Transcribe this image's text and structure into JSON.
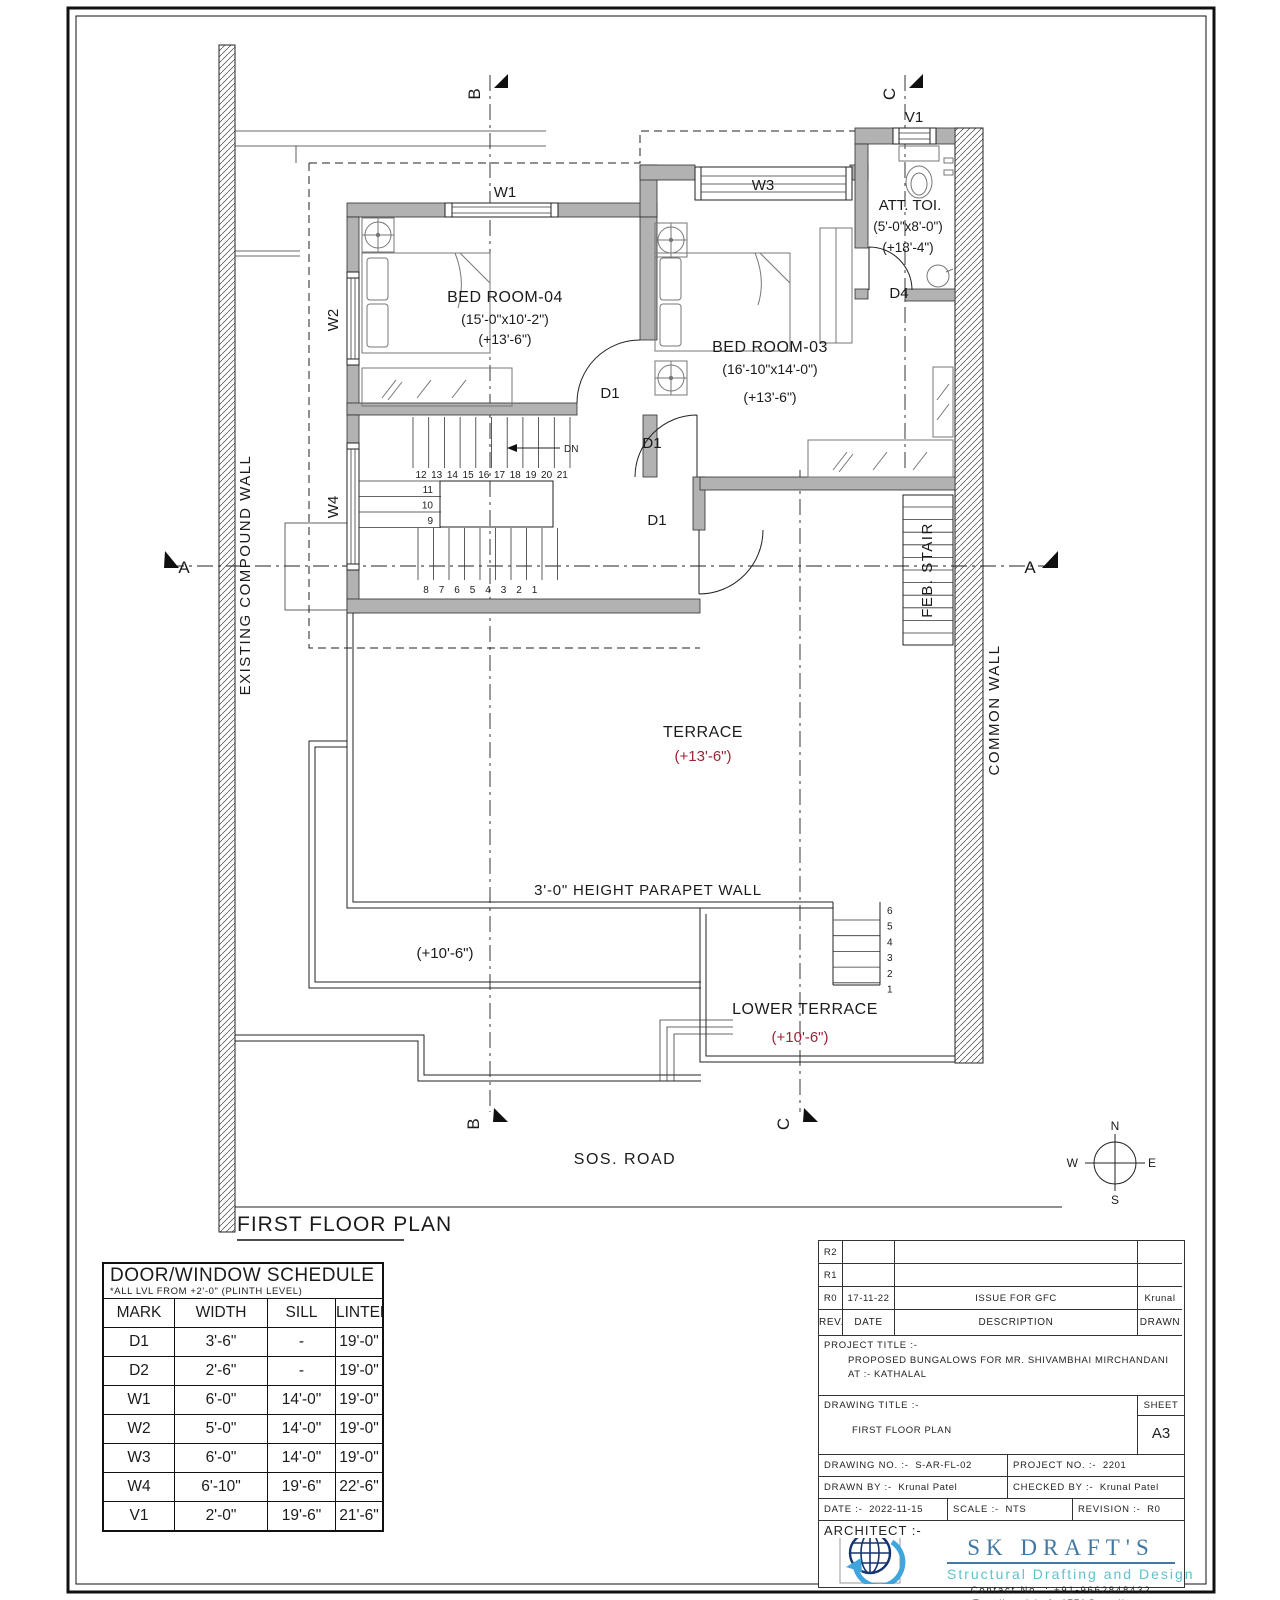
{
  "drawing": {
    "plan_title": "FIRST FLOOR PLAN",
    "road_label": "SOS. ROAD",
    "colors": {
      "level_red": "#9b2335",
      "wall_gray": "#b2b2b2",
      "brand_blue": "#4179a4",
      "brand_teal": "#5ec1ca"
    },
    "rooms": {
      "bedroom4": {
        "name": "BED ROOM-04",
        "size": "(15'-0\"x10'-2\")",
        "level": "(+13'-6\")"
      },
      "bedroom3": {
        "name": "BED ROOM-03",
        "size": "(16'-10\"x14'-0\")",
        "level": "(+13'-6\")"
      },
      "toilet": {
        "name": "ATT. TOI.",
        "size": "(5'-0\"x8'-0\")",
        "level": "(+18'-4\")"
      },
      "terrace": {
        "name": "TERRACE",
        "level": "(+13'-6\")"
      },
      "lower_terrace": {
        "name": "LOWER TERRACE",
        "level": "(+10'-6\")"
      },
      "roof_level": "(+10'-6\")"
    },
    "labels": {
      "parapet": "3'-0\" HEIGHT PARAPET WALL",
      "existing_compound_wall": "EXISTING COMPOUND WALL",
      "common_wall": "COMMON WALL",
      "feb_stair": "FEB. STAIR",
      "dn": "DN"
    },
    "tags": {
      "w1": "W1",
      "w2": "W2",
      "w3": "W3",
      "w4": "W4",
      "v1": "V1",
      "d1": "D1",
      "d4": "D4"
    },
    "sections": {
      "a": "A",
      "b": "B",
      "c": "C"
    },
    "compass": {
      "n": "N",
      "s": "S",
      "e": "E",
      "w": "W"
    },
    "stairs": {
      "upper_run": [
        "12",
        "13",
        "14",
        "15",
        "16",
        "17",
        "18",
        "19",
        "20",
        "21"
      ],
      "mid_run": [
        "11",
        "10",
        "9"
      ],
      "lower_run": [
        "8",
        "7",
        "6",
        "5",
        "4",
        "3",
        "2",
        "1"
      ],
      "terrace_steps": [
        "6",
        "5",
        "4",
        "3",
        "2",
        "1"
      ]
    }
  },
  "schedule": {
    "title": "DOOR/WINDOW SCHEDULE",
    "subtitle": "*ALL LVL FROM +2'-0\" (PLINTH LEVEL)",
    "headers": [
      "MARK",
      "WIDTH",
      "SILL",
      "LINTEL"
    ],
    "rows": [
      {
        "mark": "D1",
        "width": "3'-6\"",
        "sill": "-",
        "lintel": "19'-0\""
      },
      {
        "mark": "D2",
        "width": "2'-6\"",
        "sill": "-",
        "lintel": "19'-0\""
      },
      {
        "mark": "W1",
        "width": "6'-0\"",
        "sill": "14'-0\"",
        "lintel": "19'-0\""
      },
      {
        "mark": "W2",
        "width": "5'-0\"",
        "sill": "14'-0\"",
        "lintel": "19'-0\""
      },
      {
        "mark": "W3",
        "width": "6'-0\"",
        "sill": "14'-0\"",
        "lintel": "19'-0\""
      },
      {
        "mark": "W4",
        "width": "6'-10\"",
        "sill": "19'-6\"",
        "lintel": "22'-6\""
      },
      {
        "mark": "V1",
        "width": "2'-0\"",
        "sill": "19'-6\"",
        "lintel": "21'-6\""
      }
    ]
  },
  "titleblock": {
    "rev_headers": {
      "rev": "REV.",
      "date": "DATE",
      "description": "DESCRIPTION",
      "drawn": "DRAWN"
    },
    "revisions": [
      {
        "rev": "R2",
        "date": "",
        "description": "",
        "drawn": ""
      },
      {
        "rev": "R1",
        "date": "",
        "description": "",
        "drawn": ""
      },
      {
        "rev": "R0",
        "date": "17-11-22",
        "description": "ISSUE FOR GFC",
        "drawn": "Krunal"
      }
    ],
    "project_title_label": "PROJECT TITLE :-",
    "project_title_line1": "PROPOSED BUNGALOWS FOR MR. SHIVAMBHAI MIRCHANDANI",
    "project_title_line2": "AT :- KATHALAL",
    "drawing_title_label": "DRAWING TITLE :-",
    "drawing_title": "FIRST FLOOR PLAN",
    "sheet_label": "SHEET",
    "sheet": "A3",
    "drawing_no_label": "DRAWING NO. :-",
    "drawing_no": "S-AR-FL-02",
    "project_no_label": "PROJECT NO. :-",
    "project_no": "2201",
    "drawn_by_label": "DRAWN BY :-",
    "drawn_by": "Krunal Patel",
    "checked_by_label": "CHECKED BY :-",
    "checked_by": "Krunal Patel",
    "date_label": "DATE :-",
    "date": "2022-11-15",
    "scale_label": "SCALE :-",
    "scale": "NTS",
    "revision_label": "REVISION :-",
    "revision": "R0",
    "architect_label": "ARCHITECT :-",
    "brand": {
      "name": "SK DRAFT'S",
      "tagline": "Structural Drafting and Design",
      "contact_label": "Contact No. :",
      "contact": "+91-9662848432",
      "email_label": "E-mail :",
      "email": "skdrafts1771@gmail.com"
    }
  }
}
